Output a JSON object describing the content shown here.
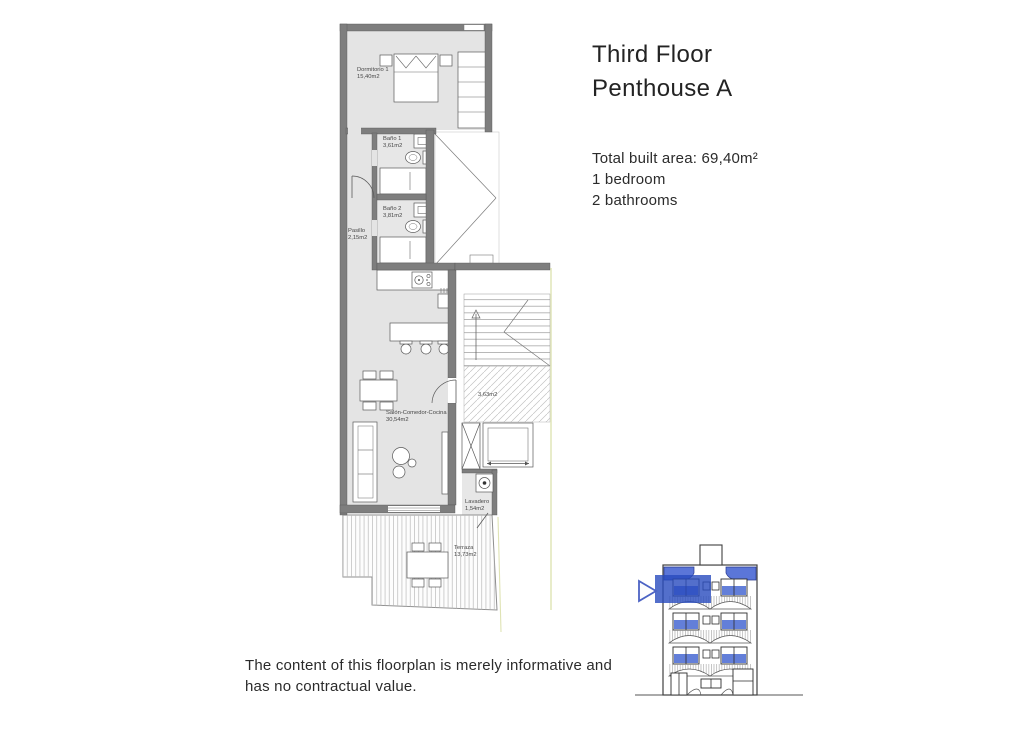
{
  "header": {
    "title_line1": "Third Floor",
    "title_line2": "Penthouse A"
  },
  "summary": {
    "total_area": "Total built area: 69,40m²",
    "bedrooms": "1 bedroom",
    "bathrooms": "2 bathrooms"
  },
  "disclaimer": {
    "line1": "The content of this floorplan is merely informative and",
    "line2": "has no contractual value."
  },
  "floorplan": {
    "rooms": {
      "dormitorio": {
        "name": "Dormitorio 1",
        "area": "15,40m2"
      },
      "bano1": {
        "name": "Baño 1",
        "area": "3,61m2"
      },
      "bano2": {
        "name": "Baño 2",
        "area": "3,81m2"
      },
      "pasillo": {
        "name": "Pasillo",
        "area": "2,15m2"
      },
      "salon": {
        "name": "Salón-Comedor-Cocina",
        "area": "30,54m2"
      },
      "lavadero": {
        "name": "Lavadero",
        "area": "1,54m2"
      },
      "terraza": {
        "name": "Terraza",
        "area": "13,73m2"
      }
    },
    "landing": {
      "area": "3,63m2"
    }
  },
  "colors": {
    "wall_gray": "#7e7e7e",
    "floor_gray": "#e4e4e4",
    "accent_blue": "#5b76d8",
    "highlight_blue": "#2b4bbe",
    "boundary_yellow": "#dfe3b4"
  }
}
